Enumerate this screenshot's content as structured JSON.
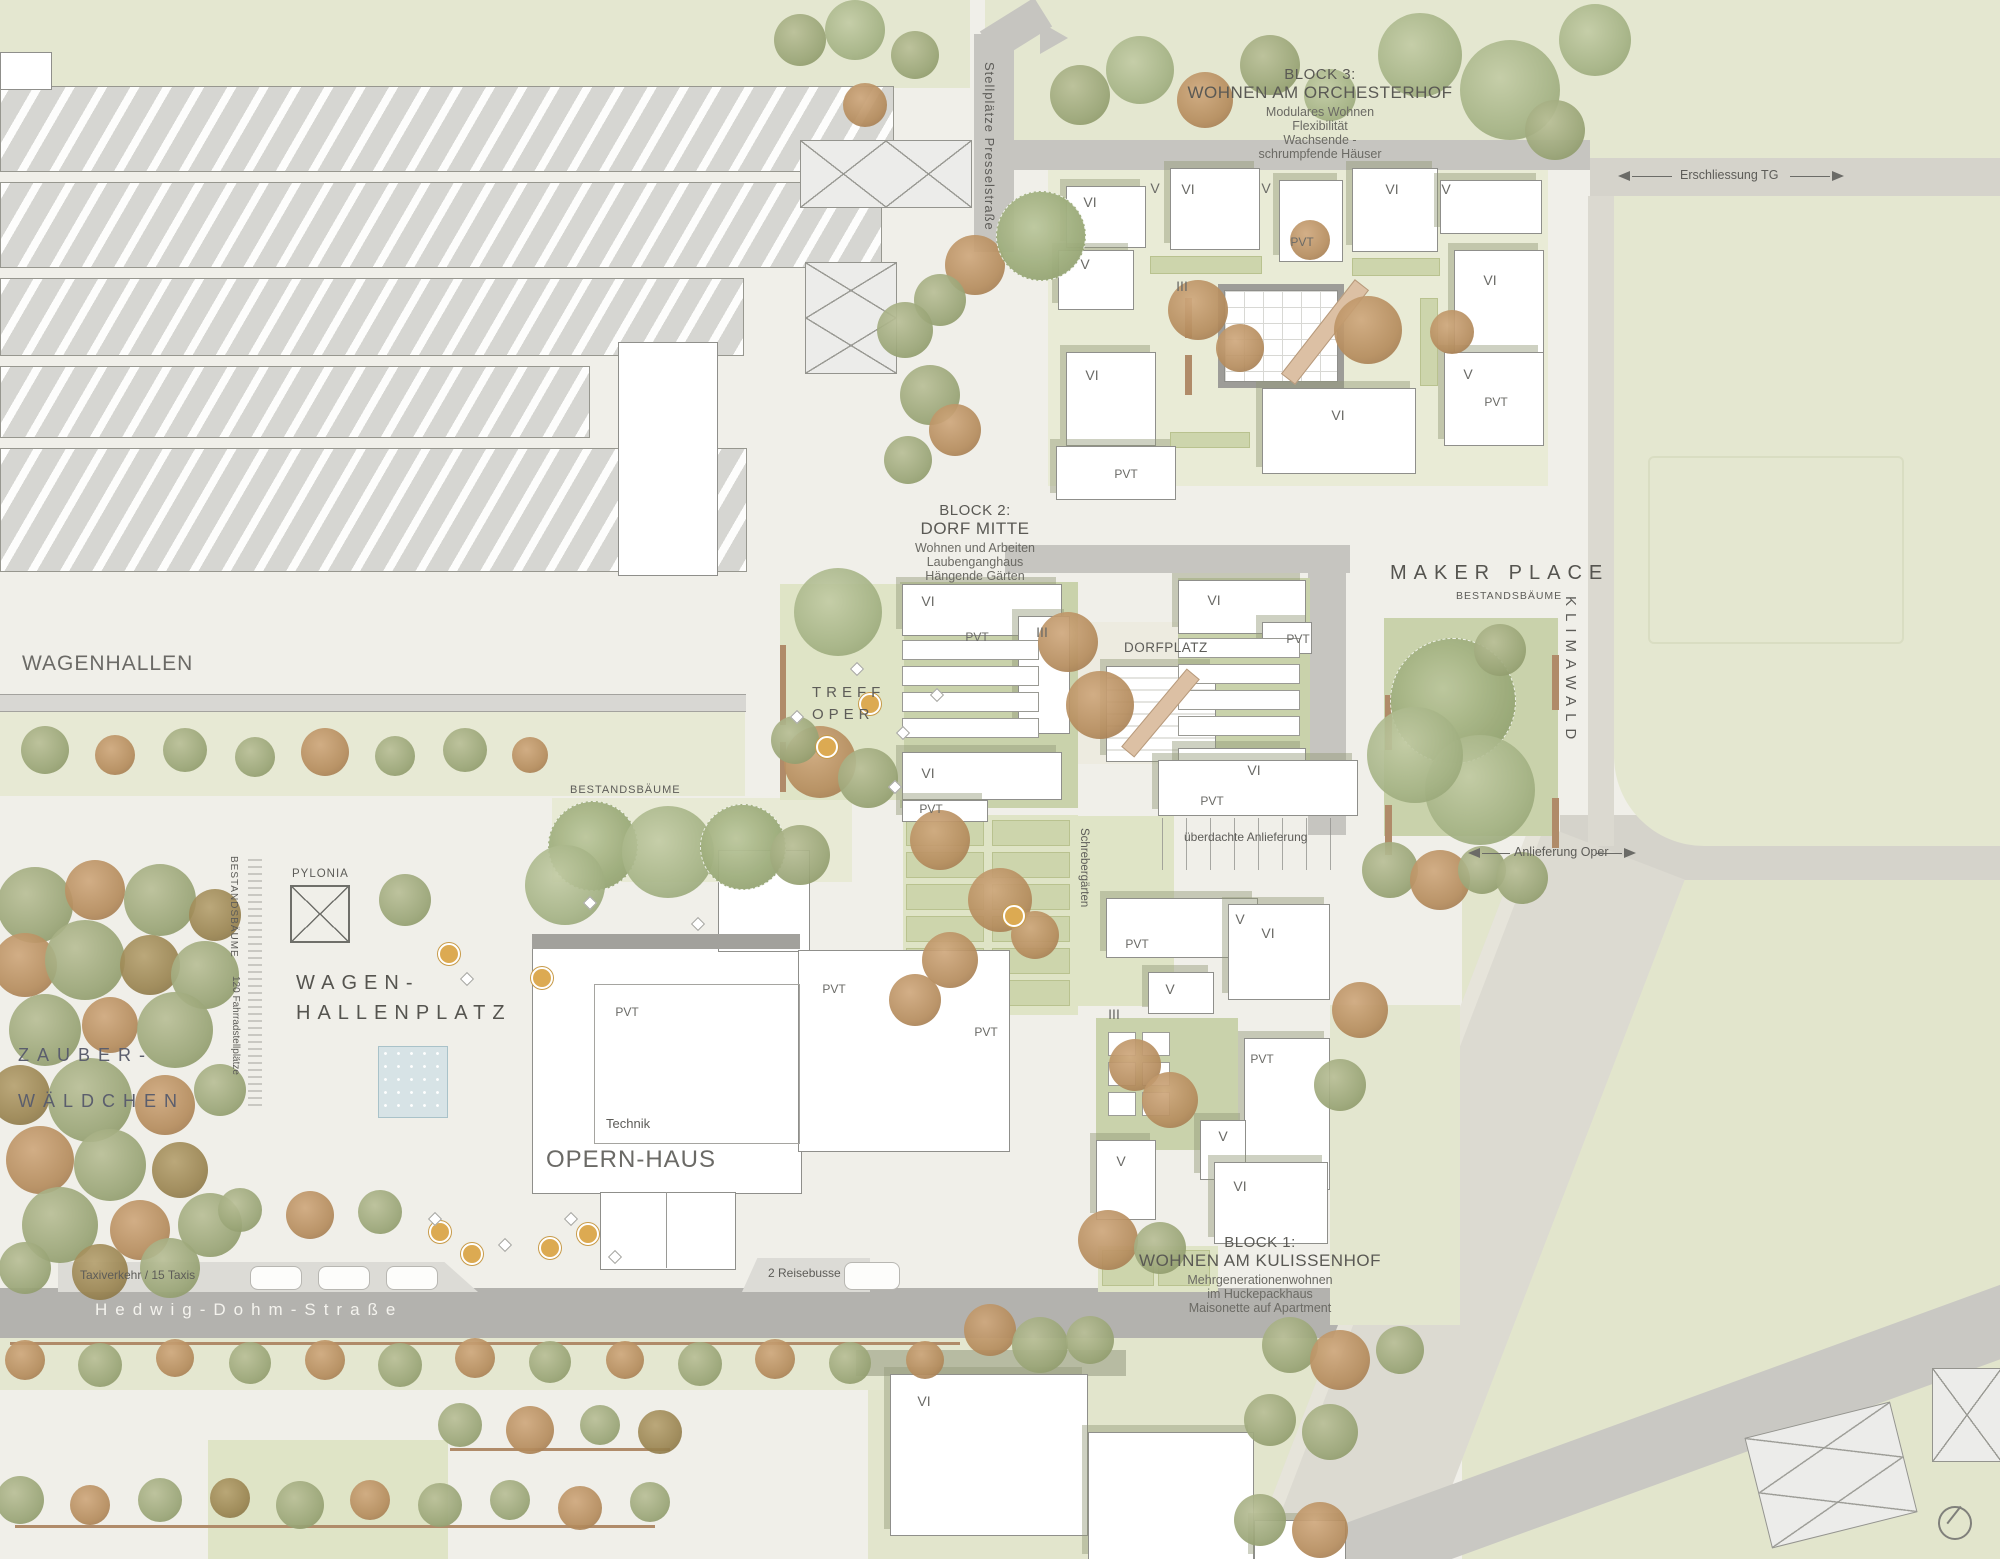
{
  "blocks": [
    {
      "id": "block-1",
      "title": "BLOCK 1:",
      "name": "WOHNEN AM KULISSENHOF",
      "lines": [
        "Mehrgenerationenwohnen",
        "im Huckepackhaus",
        "Maisonette auf Apartment"
      ]
    },
    {
      "id": "block-2",
      "title": "BLOCK 2:",
      "name": "DORF MITTE",
      "lines": [
        "Wohnen und Arbeiten",
        "Laubenganghaus",
        "Hängende Gärten"
      ]
    },
    {
      "id": "block-3",
      "title": "BLOCK 3:",
      "name": "WOHNEN AM ORCHESTERHOF",
      "lines": [
        "Modulares Wohnen",
        "Flexibilität",
        "Wachsende -",
        "schrumpfende Häuser"
      ]
    }
  ],
  "places": {
    "wagenhallen": "WAGENHALLEN",
    "wagenhallenplatz": [
      "WAGEN-",
      "HALLENPLATZ"
    ],
    "zauberwaeldchen": [
      "ZAUBER-",
      "WÄLDCHEN"
    ],
    "opernhaus": "OPERN-HAUS",
    "technik": "Technik",
    "makerplace": "MAKER PLACE",
    "klimawald": "KLIMAWALD",
    "dorfplatz": "DORFPLATZ",
    "treffoper": [
      "TREFF",
      "OPER"
    ],
    "pylonia": "PYLONIA"
  },
  "streets": {
    "hedwig_dohm": "Hedwig-Dohm-Straße",
    "presselstrasse": "Stellplätze Presselstraße",
    "erschliessung_tg": "Erschliessung TG",
    "anlieferung_oper": "Anlieferung Oper",
    "ueberdachte_anlieferung": "überdachte Anlieferung",
    "taxi": "Taxiverkehr / 15 Taxis",
    "reisebusse": "2 Reisebusse",
    "schrebergaerten": "Schrebergärten"
  },
  "annotations": {
    "bestandsbaeume_platz": "BESTANDSBÄUME",
    "bestandsbaeume_mitte": "BESTANDSBÄUME",
    "bestandsbaeume_maker": "BESTANDSBÄUME",
    "fahrradstellplaetze": "120 Fahrradstellplätze"
  },
  "building_level_labels": [
    {
      "text": "VI",
      "x": 1090,
      "y": 202
    },
    {
      "text": "V",
      "x": 1155,
      "y": 188
    },
    {
      "text": "VI",
      "x": 1188,
      "y": 189
    },
    {
      "text": "V",
      "x": 1266,
      "y": 188
    },
    {
      "text": "VI",
      "x": 1392,
      "y": 189
    },
    {
      "text": "V",
      "x": 1446,
      "y": 189
    },
    {
      "text": "PVT",
      "x": 1302,
      "y": 242
    },
    {
      "text": "V",
      "x": 1085,
      "y": 264
    },
    {
      "text": "III",
      "x": 1182,
      "y": 286
    },
    {
      "text": "VI",
      "x": 1092,
      "y": 375
    },
    {
      "text": "VI",
      "x": 1490,
      "y": 280
    },
    {
      "text": "V",
      "x": 1468,
      "y": 374
    },
    {
      "text": "PVT",
      "x": 1496,
      "y": 402
    },
    {
      "text": "VI",
      "x": 1338,
      "y": 415
    },
    {
      "text": "PVT",
      "x": 1126,
      "y": 474
    },
    {
      "text": "VI",
      "x": 928,
      "y": 601
    },
    {
      "text": "VI",
      "x": 1214,
      "y": 600
    },
    {
      "text": "PVT",
      "x": 977,
      "y": 637
    },
    {
      "text": "III",
      "x": 1042,
      "y": 632
    },
    {
      "text": "PVT",
      "x": 1298,
      "y": 639
    },
    {
      "text": "VI",
      "x": 928,
      "y": 773
    },
    {
      "text": "VI",
      "x": 1254,
      "y": 770
    },
    {
      "text": "PVT",
      "x": 931,
      "y": 809
    },
    {
      "text": "PVT",
      "x": 1137,
      "y": 944
    },
    {
      "text": "V",
      "x": 1240,
      "y": 919
    },
    {
      "text": "VI",
      "x": 1268,
      "y": 933
    },
    {
      "text": "V",
      "x": 1170,
      "y": 989
    },
    {
      "text": "III",
      "x": 1114,
      "y": 1014
    },
    {
      "text": "PVT",
      "x": 1262,
      "y": 1059
    },
    {
      "text": "V",
      "x": 1121,
      "y": 1161
    },
    {
      "text": "V",
      "x": 1223,
      "y": 1136
    },
    {
      "text": "VI",
      "x": 1240,
      "y": 1186
    },
    {
      "text": "PVT",
      "x": 627,
      "y": 1012
    },
    {
      "text": "PVT",
      "x": 834,
      "y": 989
    },
    {
      "text": "PVT",
      "x": 986,
      "y": 1032
    },
    {
      "text": "PVT",
      "x": 1212,
      "y": 801
    },
    {
      "text": "VI",
      "x": 924,
      "y": 1401
    }
  ],
  "colors": {
    "paper": "#f0efe9",
    "green_light": "#e4e7d0",
    "green_sage": "#c9d2ab",
    "road": "#c6c5c0",
    "road_dark": "#b3b2ae",
    "building": "#ffffff",
    "building_outline": "#8f8f8b",
    "tree_olive": "#9aa577",
    "tree_rust": "#b58c5d",
    "label": "#5d5c58",
    "street_label": "#f5f4ef",
    "ramp": "#dcc0a4",
    "pool": "#d7e3e6"
  }
}
